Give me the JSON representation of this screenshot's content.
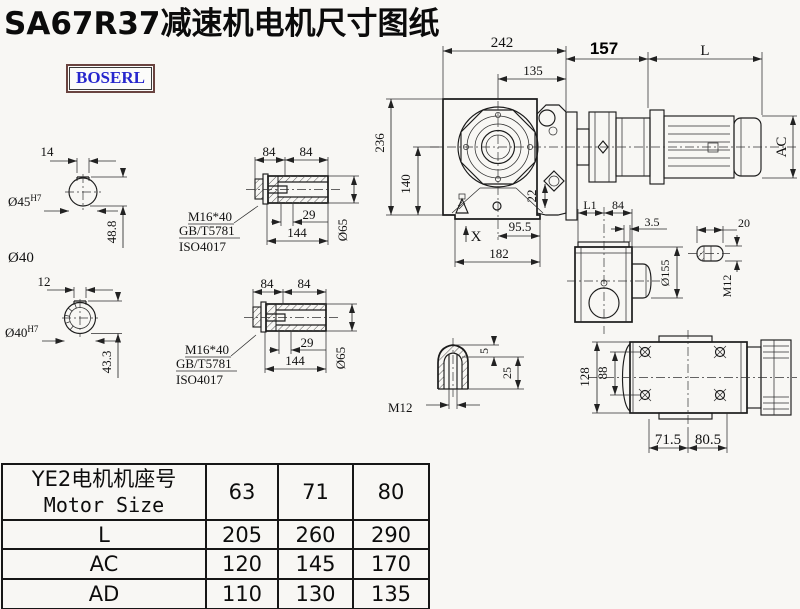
{
  "page": {
    "title": "SA67R37减速机电机尺寸图纸",
    "logo": "BOSERL"
  },
  "labels": {
    "shaft_top": {
      "key_width": "14",
      "dia": "Ø45",
      "fit": "H7",
      "height": "48.8",
      "shaft_dia": "Ø40"
    },
    "shaft_bottom": {
      "key_width": "12",
      "dia": "Ø40",
      "fit": "H7",
      "height": "43.3"
    },
    "bushing_top": {
      "seg_a": "84",
      "seg_b": "84",
      "bolt": "M16*40",
      "std_gb": "GB/T5781",
      "std_iso": "ISO4017",
      "depth": "29",
      "length": "144",
      "dia": "Ø65"
    },
    "bushing_bottom": {
      "seg_a": "84",
      "seg_b": "84",
      "bolt": "M16*40",
      "std_gb": "GB/T5781",
      "std_iso": "ISO4017",
      "depth": "29",
      "length": "144",
      "dia": "Ø65"
    },
    "front_view": {
      "width_total": "242",
      "width_center": "135",
      "width_input": "157",
      "motor_length": "L",
      "height_total": "236",
      "height_center": "140",
      "plug": "22",
      "motor_dia": "AC",
      "x_mark": "X",
      "foot": "95.5",
      "base": "182"
    },
    "side_view": {
      "l1": "L1",
      "w84": "84",
      "gap": "3.5",
      "key_len": "20",
      "flange_dia": "Ø155",
      "thread": "M12"
    },
    "cap_detail": {
      "tip": "5",
      "depth": "25",
      "thread": "M12"
    },
    "top_view": {
      "height": "128",
      "bolt_span": "88",
      "left": "71.5",
      "right": "80.5"
    }
  },
  "table": {
    "header": {
      "label_cn": "YE2电机机座号",
      "label_en": "Motor Size",
      "columns": [
        "63",
        "71",
        "80"
      ]
    },
    "rows": [
      {
        "name": "L",
        "values": [
          "205",
          "260",
          "290"
        ]
      },
      {
        "name": "AC",
        "values": [
          "120",
          "145",
          "170"
        ]
      },
      {
        "name": "AD",
        "values": [
          "110",
          "130",
          "135"
        ]
      }
    ]
  }
}
